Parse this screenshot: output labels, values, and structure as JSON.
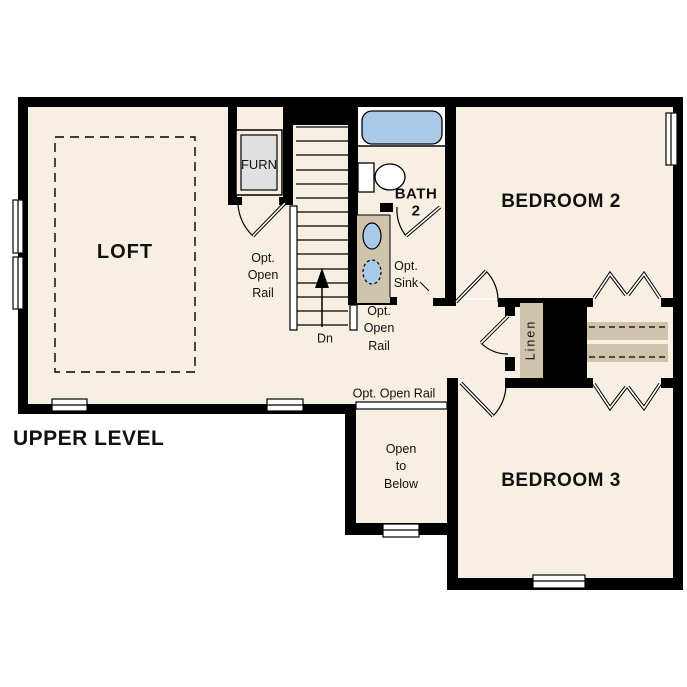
{
  "title": "UPPER LEVEL",
  "rooms": {
    "loft": "LOFT",
    "bedroom2": "BEDROOM 2",
    "bedroom3": "BEDROOM 3",
    "bath": "BATH\n2",
    "furnace": "FURN",
    "linen": "Linen",
    "open_to_below": "Open\nto\nBelow"
  },
  "annotations": {
    "stair_direction": "Dn",
    "opt_open_rail_stairs_left": "Opt.\nOpen\nRail",
    "opt_open_rail_stairs_right": "Opt.\nOpen\nRail",
    "opt_open_rail_loft_edge": "Opt. Open Rail",
    "opt_sink": "Opt.\nSink"
  },
  "colors": {
    "wall": "#000000",
    "floor": "#f7efe2",
    "casework": "#cfc3ab",
    "fixture_blue": "#a9c9e9",
    "furnace_gray": "#e0e0e0"
  }
}
